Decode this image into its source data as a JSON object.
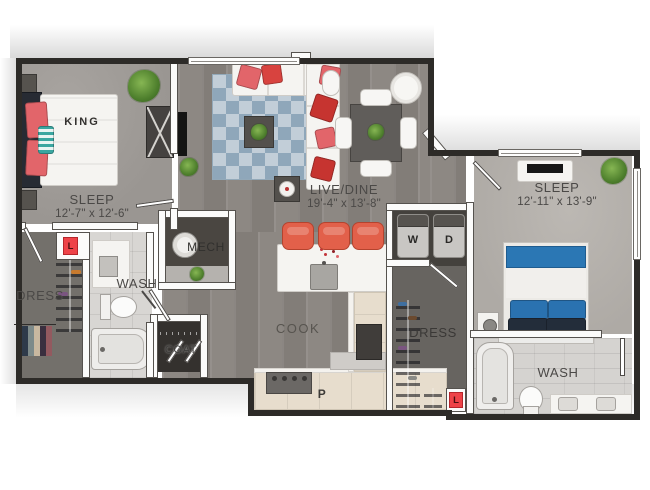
{
  "palette": {
    "wall": "#2d2b28",
    "wood_floor": "#8a8580",
    "carpet_bedroom1": "#a09c98",
    "carpet_bedroom2": "#b6b2ad",
    "tile": "#d7d5d2",
    "accent_coral": "#e2604a",
    "accent_red_pillow": "#c63430",
    "rug_blue": "#8fa7ba",
    "bed_blue": "#2b77b4",
    "linen_red": "#ee4348",
    "label_gray": "#4b4947"
  },
  "rooms": {
    "bedroom1": {
      "label": "SLEEP",
      "dimensions": "12'-7\" x 12'-6\"",
      "bed": "KING"
    },
    "living": {
      "label": "LIVE/DINE",
      "dimensions": "19'-4\" x 13'-8\""
    },
    "bedroom2": {
      "label": "SLEEP",
      "dimensions": "12'-11\" x 13'-9\""
    },
    "bathroom1": {
      "label": "WASH"
    },
    "bathroom2": {
      "label": "WASH"
    },
    "closet1": {
      "label": "DRESS"
    },
    "closet2": {
      "label": "DRESS"
    },
    "mechanical": {
      "label": "MECH"
    },
    "kitchen": {
      "label": "COOK"
    },
    "coat_closet": {
      "label": "COAT"
    },
    "pantry": {
      "label": "P"
    },
    "linen1": {
      "label": "L"
    },
    "linen2": {
      "label": "L"
    },
    "laundry": {
      "washer_label": "W",
      "dryer_label": "D"
    }
  }
}
